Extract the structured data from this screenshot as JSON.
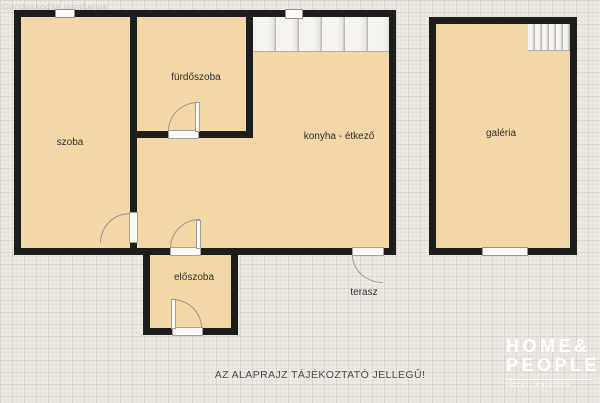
{
  "watermark": "Gondoskodás ingatlanok",
  "plan": {
    "rooms": [
      {
        "label": "szoba"
      },
      {
        "label": "fürdőszoba"
      },
      {
        "label": "konyha - étkező"
      },
      {
        "label": "galéria"
      },
      {
        "label": "előszoba"
      },
      {
        "label": "terasz"
      }
    ],
    "disclaimer": "AZ ALAPRAJZ TÁJÉKOZTATÓ JELLEGŰ!"
  },
  "logo": {
    "line1": "HOME&",
    "line2": "PEOPLE",
    "tagline": "INGATLANIRODA"
  },
  "colors": {
    "background": "#eceae5",
    "room_fill": "#f3d8a7",
    "wall": "#1d1d1b",
    "stairs_fill": "#f2f1ee",
    "label_text": "#2e2e2e",
    "disclaimer_text": "#4d4d4d",
    "logo_text": "#ffffff"
  }
}
